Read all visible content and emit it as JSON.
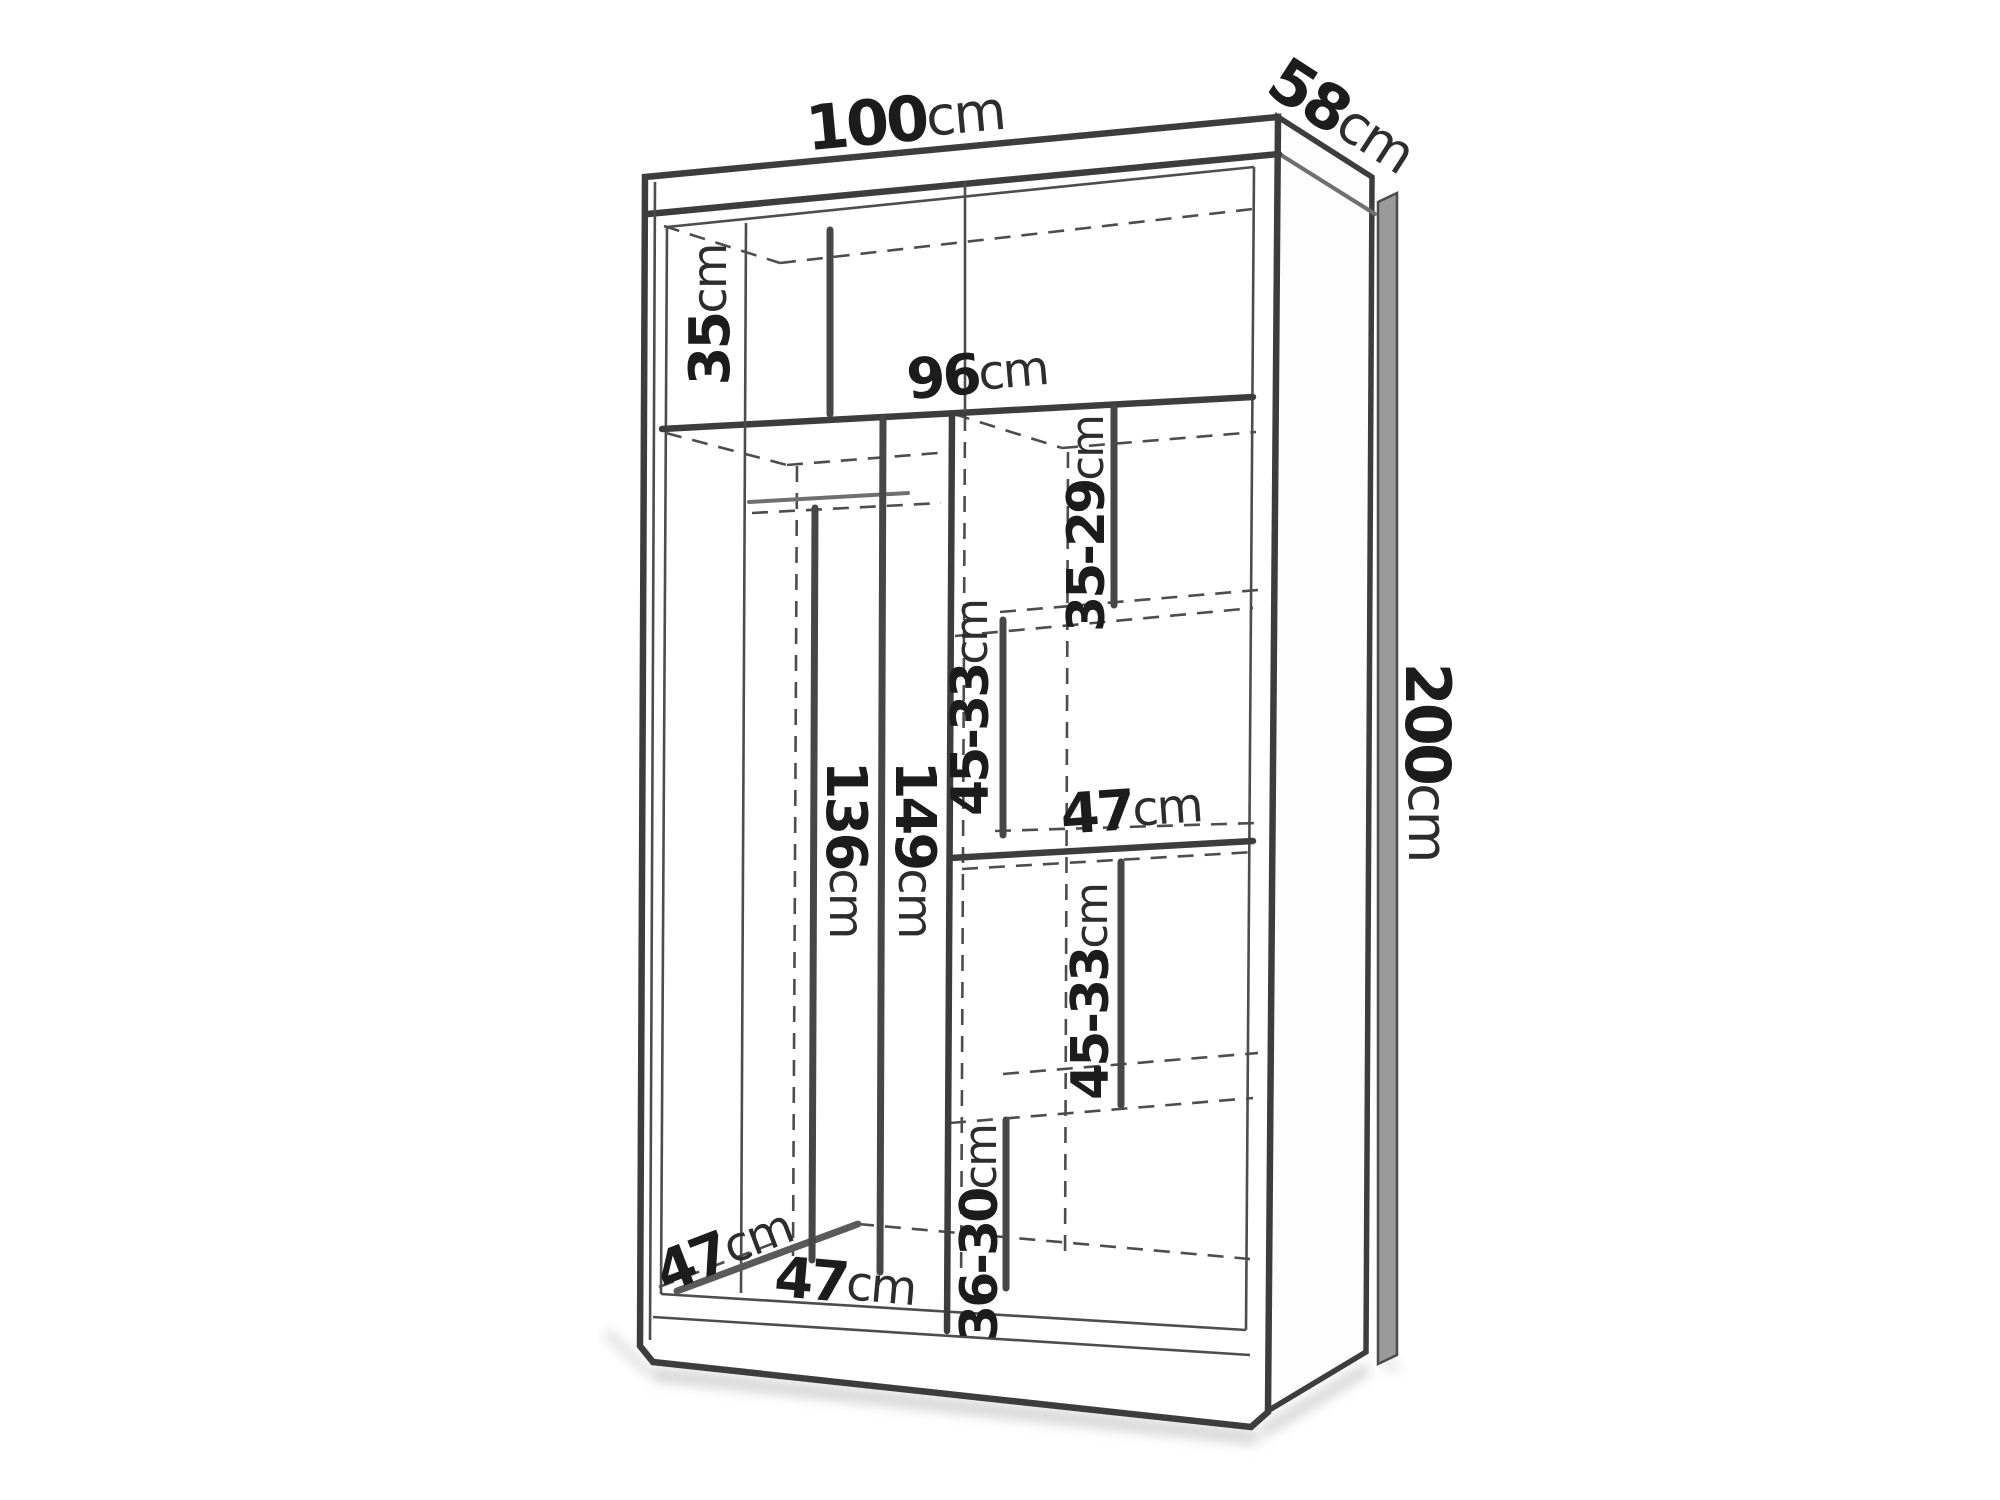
{
  "diagram": {
    "subject": "wardrobe-dimension-diagram",
    "dimensions": {
      "overall_width": {
        "value": "100",
        "unit": "cm"
      },
      "overall_depth": {
        "value": "58",
        "unit": "cm"
      },
      "overall_height": {
        "value": "200",
        "unit": "cm"
      },
      "interior_width": {
        "value": "96",
        "unit": "cm"
      },
      "top_compartment_height": {
        "value": "35",
        "unit": "cm"
      },
      "right_top_gap": {
        "value": "35-29",
        "unit": "cm"
      },
      "right_upper_gap": {
        "value": "45-33",
        "unit": "cm"
      },
      "shelf_width": {
        "value": "47",
        "unit": "cm"
      },
      "right_lower_gap": {
        "value": "45-33",
        "unit": "cm"
      },
      "right_bottom_gap": {
        "value": "36-30",
        "unit": "cm"
      },
      "hanging_space_height": {
        "value": "136",
        "unit": "cm"
      },
      "left_compartment_height": {
        "value": "149",
        "unit": "cm"
      },
      "interior_depth": {
        "value": "47",
        "unit": "cm"
      },
      "left_compartment_width": {
        "value": "47",
        "unit": "cm"
      }
    },
    "colors": {
      "background": "#ffffff",
      "outline": "#3d3d3d",
      "medium_line": "#6f6f6f",
      "dashed_line": "#4d4d4d",
      "label_number": "#1c1c1c",
      "label_unit": "#2d2d2d",
      "side_panel_fill": "#9a9a9a",
      "shadow": "#c6c6c6"
    }
  }
}
